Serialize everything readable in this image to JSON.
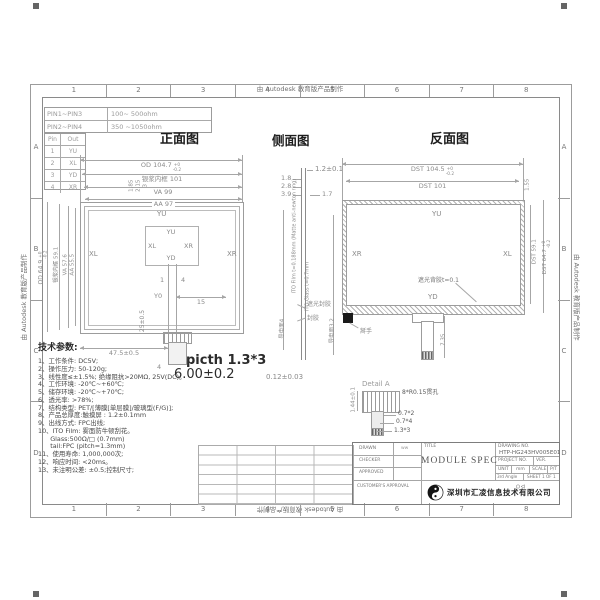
{
  "sheet": {
    "watermark": "由 Autodesk 教育版产品制作",
    "grid_cols": [
      "1",
      "2",
      "3",
      "4",
      "5",
      "6",
      "7",
      "8"
    ],
    "grid_rows": [
      "A",
      "B",
      "C",
      "D"
    ]
  },
  "res_table": {
    "r1c1": "PIN1~PIN3",
    "r1c2": "100~ 500ohm",
    "r2c1": "PIN2~PIN4",
    "r2c2": "350 ~1050ohm"
  },
  "pinout": {
    "h1": "Pin",
    "h2": "Out",
    "rows": [
      [
        "1",
        "YU"
      ],
      [
        "2",
        "XL"
      ],
      [
        "3",
        "YD"
      ],
      [
        "4",
        "XR"
      ]
    ]
  },
  "front": {
    "title": "正面图",
    "od_h": "OD 104.7",
    "od_h_plus": "+0",
    "od_h_minus": "-0.2",
    "frame_h": "银浆内框 101",
    "va_h": "VA 99",
    "aa_h": "AA 97",
    "od_v": "OD 64.9",
    "od_v_plus": "+0",
    "od_v_minus": "-0.2",
    "frame_v": "银浆内框 59.1",
    "va_v": "VA 57.6",
    "aa_v": "AA 55.5",
    "inset1": "1.85",
    "inset2": "2.15",
    "inset3": "3",
    "lbl_yu": "YU",
    "lbl_xl": "XL",
    "lbl_xr": "XR",
    "lbl_y0": "Y0",
    "box_yu": "YU",
    "box_xl": "XL",
    "box_xr": "XR",
    "box_yd": "YD",
    "pin1": "1",
    "pin4": "4",
    "dim15": "15",
    "dim47": "47.5±0.5",
    "dim25": "25±0.5",
    "dim4": "4",
    "pitch": "picth 1.3*3",
    "dim6": "6.00±0.2"
  },
  "side": {
    "title": "侧面图",
    "dim12": "1.2±0.1",
    "d18": "1.8",
    "d28": "2.8",
    "d39": "3.9",
    "d17": "1.7",
    "film": "ITO Film t=0.188mm (Matte anti-newton ring)",
    "glass": "ITO Glass t=0.7mm",
    "seal1": "遮光封胶",
    "seal2": "封胶",
    "cond_l": "导电面4",
    "cond_r": "导电面3.2",
    "d012": "0.12±0.03"
  },
  "back": {
    "title": "反面图",
    "dst_h": "DST 104.5",
    "dst_h_plus": "+0",
    "dst_h_minus": "-0.2",
    "dst101": "DST 101",
    "d155": "1.55",
    "dst_v1": "DST 59.1",
    "dst_v2": "DST 64.7",
    "dst_v2_plus": "+0",
    "dst_v2_minus": "-0.2",
    "lbl_yu": "YU",
    "lbl_xr": "XR",
    "lbl_xl": "XL",
    "lbl_yd": "YD",
    "glue": "遮光背胶t=0.1",
    "tab": "掰手",
    "d735": "7.35"
  },
  "detail": {
    "title": "Detail A",
    "holes": "8*R0.15贯孔",
    "d072": "0.7*2",
    "d074": "0.7*4",
    "d133": "1.3*3",
    "d144": "1.44±0.1"
  },
  "tech": {
    "heading": "技术参数:",
    "items": [
      "1、工作条件: DC5V;",
      "2、操作压力: 50-120g;",
      "3、线性度≤±1.5%; 绝缘阻抗>20MΩ, 25V(DC)。",
      "4、工作环境: -20℃~+60℃;",
      "5、储存环境: -20℃~+70℃;",
      "6、透光率: >78%;",
      "7、结构类型: PET/[薄膜[单层膜]/玻璃型(F/G)];",
      "8、产品总厚度:触摸屏 : 1.2±0.1mm",
      "9、出线方式: FPC出线;",
      "10、ITO Film: 雾面防牛顿刮花。",
      "      Glass:500Ω/□ (0.7mm)",
      "      tail:FPC (pitch=1.3mm)",
      "11、使用寿命: 1,000,000次;",
      "12、响应时间: <20ms。",
      "13、未注明公差: ±0.5;控制尺寸;"
    ]
  },
  "tb": {
    "drawn": "DRAWN",
    "drawn_v": "ww",
    "checker": "CHECKER",
    "approved": "APPROVED",
    "customer": "CUSTOMER'S APPROVAL",
    "title_lbl": "TITLE",
    "title_v": "MODULE  SPEC",
    "dno_lbl": "DRAWING NO.",
    "dno_v": "HTP-HG243HV005E01",
    "project": "PROJECT NO.",
    "ver": "VER.",
    "unit": "UNIT",
    "unit_v": "mm",
    "scale": "SCALE",
    "pt": "P/T",
    "angle": "3rd Angle",
    "sheet": "SHEET 1 OF 1",
    "company": "深圳市汇凌信息技术有限公司"
  }
}
